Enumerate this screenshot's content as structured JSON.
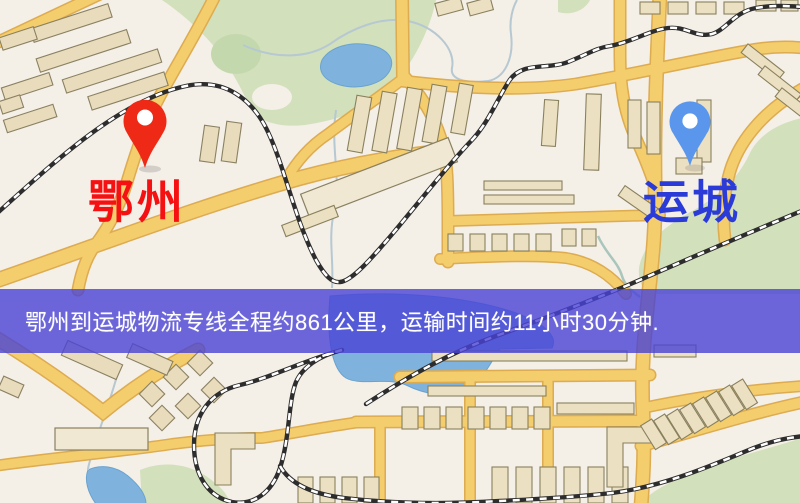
{
  "banner": {
    "text": "鄂州到运城物流专线全程约861公里，运输时间约11小时30分钟.",
    "bg_color": "rgba(72,66,214,0.80)",
    "text_color": "#ffffff"
  },
  "markers": {
    "origin": {
      "label": "鄂州",
      "pin_color": "#ee2a16",
      "label_color": "#f51111"
    },
    "destination": {
      "label": "运城",
      "pin_color": "#5a97ec",
      "label_color": "#2a3bd8"
    }
  },
  "route": {
    "from": "鄂州",
    "to": "运城",
    "distance_text": "约861公里",
    "duration_text": "约11小时30分钟"
  },
  "map_colors": {
    "background": "#f4efe7",
    "road_fill": "#f4cd6d",
    "road_casing": "#ddab50",
    "park": "#d2e0bc",
    "water": "#7fb3dd",
    "building": "#ece0c2",
    "railway": "#2d2d2d"
  }
}
